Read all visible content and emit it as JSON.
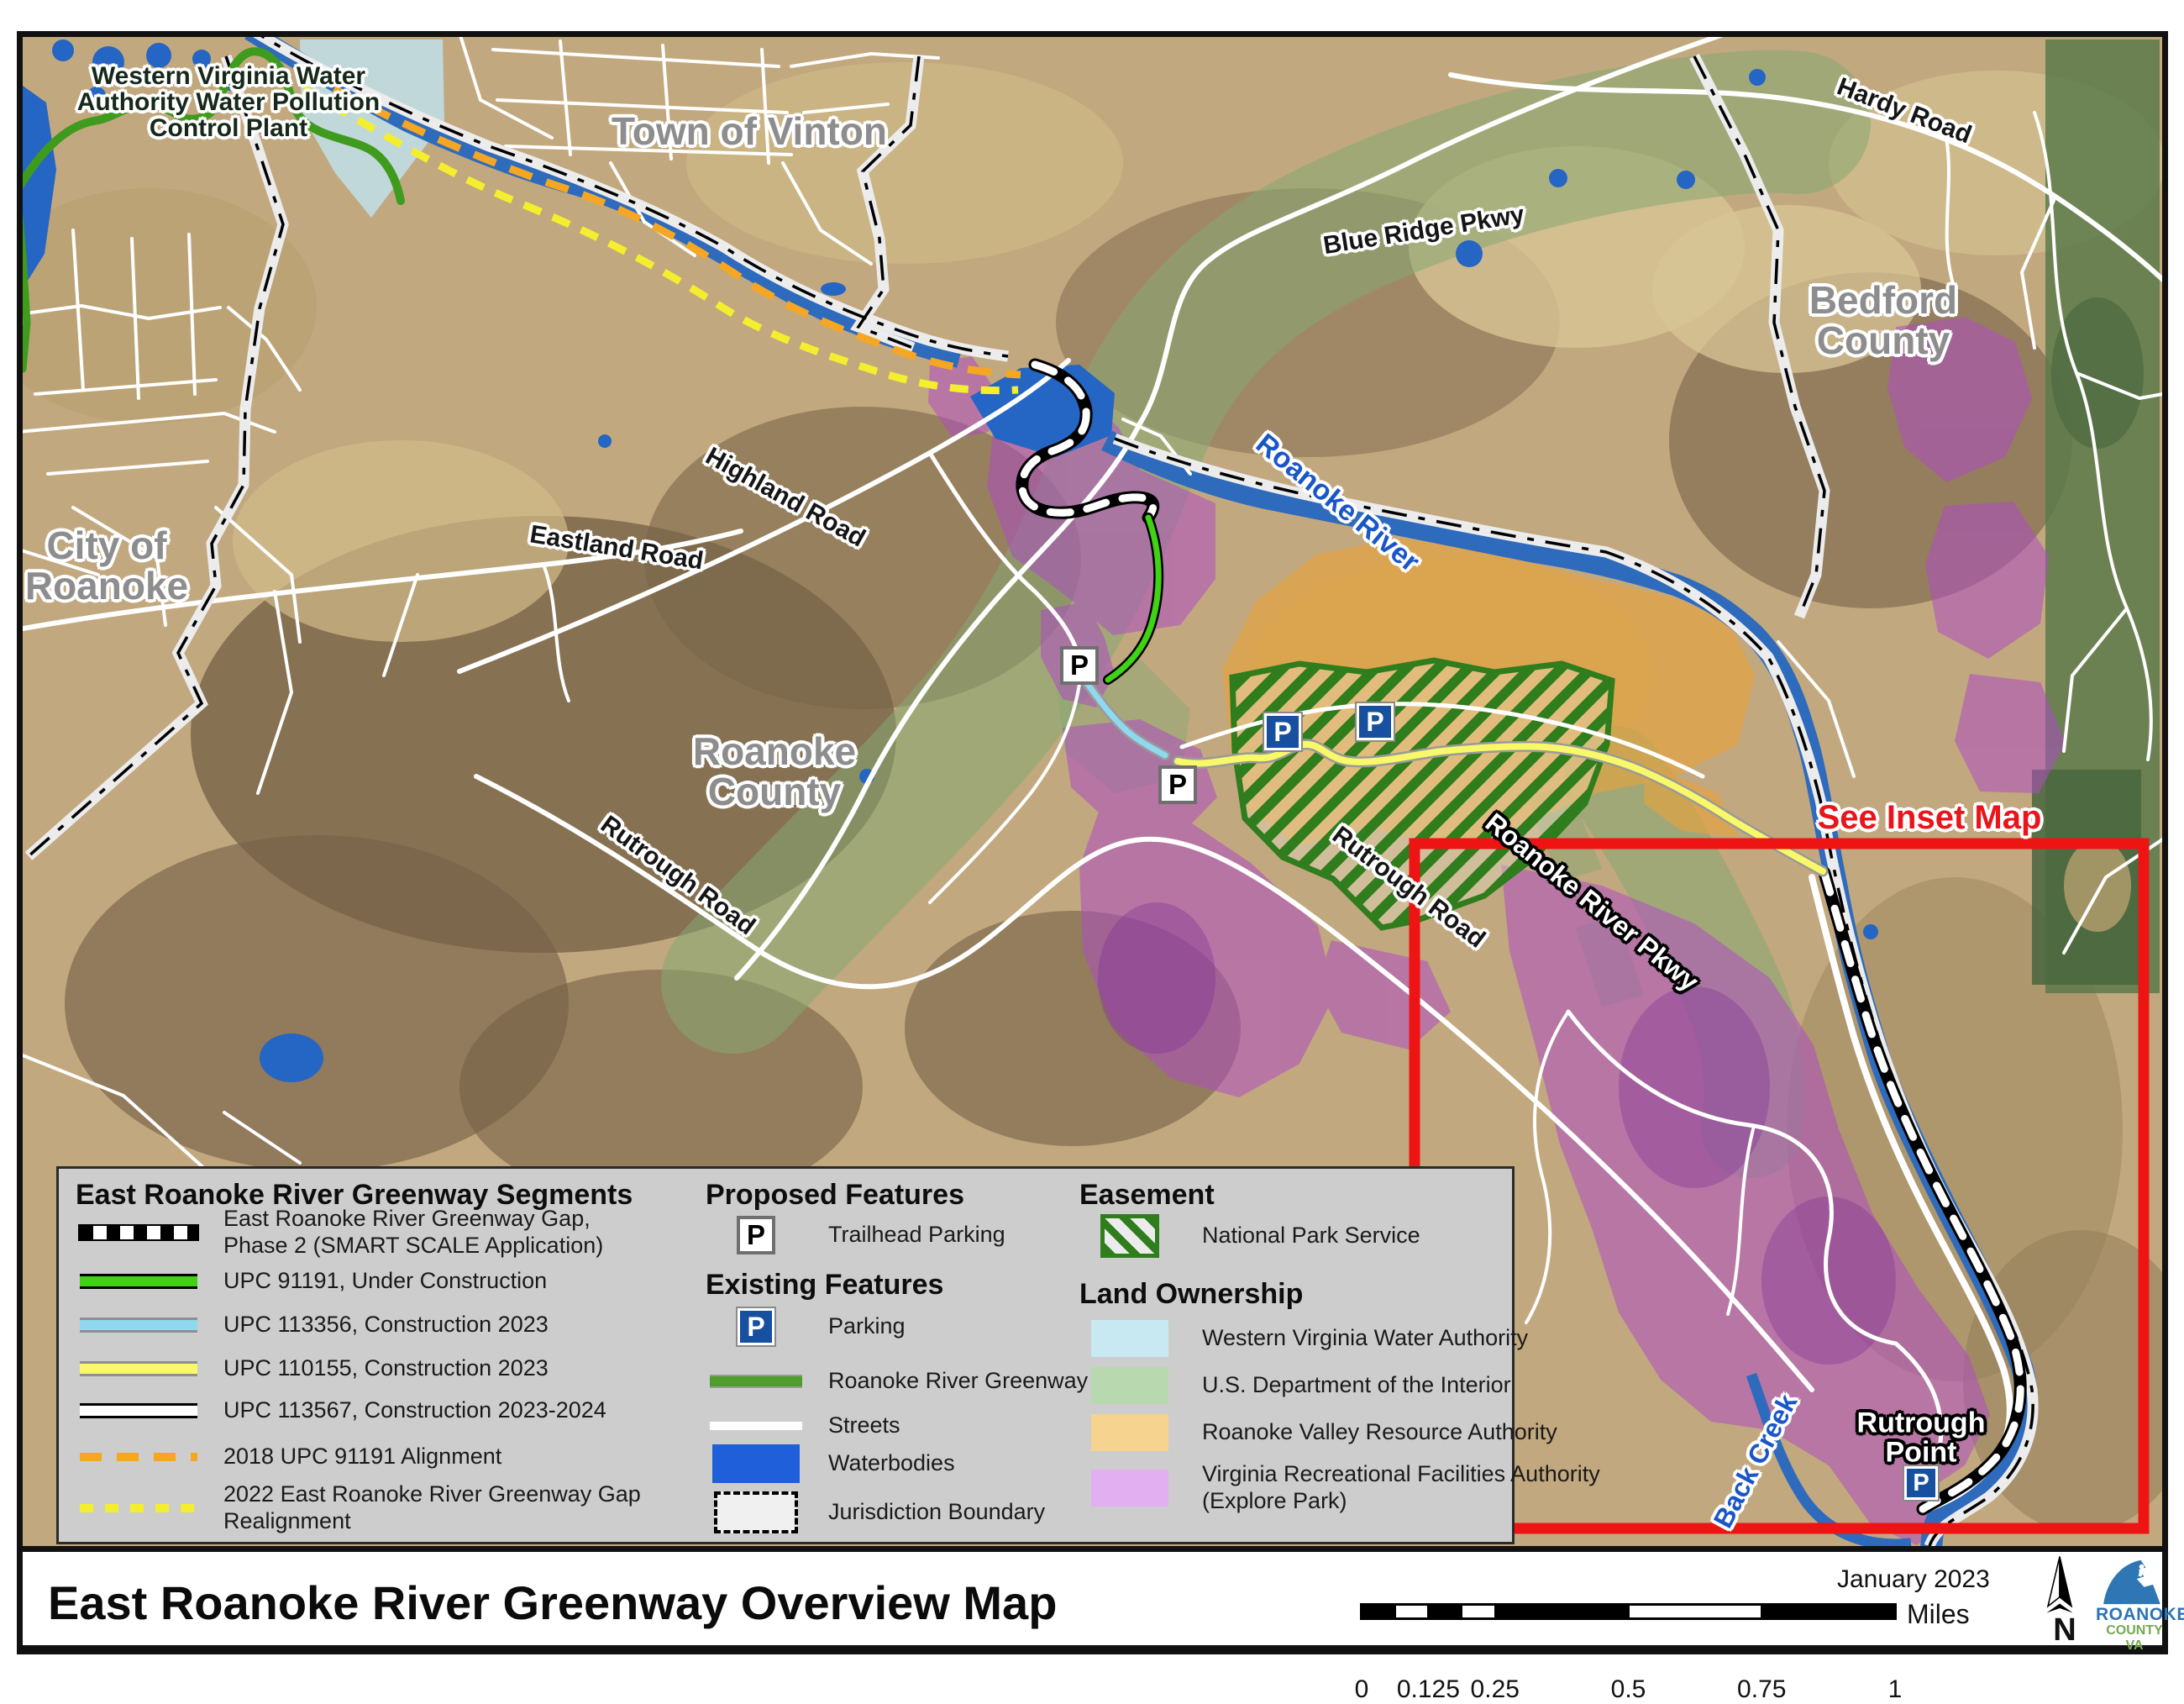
{
  "palette": {
    "inset_red": "#ee1414",
    "parking_blue": "#17509e",
    "upc_green": "#3fd313",
    "upc_cyan": "#8fd8ef",
    "upc_yellow": "#f8f868",
    "dash_orange_2018": "#f5a623",
    "dash_yellow_2022": "#f4ee2e",
    "greenway_green": "#4f9e2d",
    "waterbody_blue": "#1f5fd9",
    "nps_hatch_green": "#2f7d1d",
    "own_wvwa_blue": "#c9e9f2",
    "own_doi_green": "#b8d8b0",
    "own_rvra_orange": "#f6d38e",
    "own_vrfa_purple": "#e2aff0",
    "legend_gray": "#cdcdcd"
  },
  "map": {
    "p_letter": "P",
    "labels": {
      "plant": {
        "l1": "Western Virginia Water",
        "l2": "Authority Water Pollution",
        "l3": "Control Plant"
      },
      "vinton": "Town of Vinton",
      "city": {
        "l1": "City of",
        "l2": "Roanoke"
      },
      "county": {
        "l1": "Roanoke",
        "l2": "County"
      },
      "bedford": {
        "l1": "Bedford",
        "l2": "County"
      },
      "hardy": "Hardy Road",
      "blue_ridge": "Blue Ridge Pkwy",
      "roanoke_river": "Roanoke River",
      "highland": "Highland Road",
      "eastland": "Eastland Road",
      "rutrough_w": "Rutrough Road",
      "rutrough_e": "Rutrough Road",
      "river_pkwy": "Roanoke River Pkwy",
      "see_inset": "See Inset Map",
      "rutrough_point": {
        "l1": "Rutrough",
        "l2": "Point"
      },
      "back_creek": "Back Creek"
    }
  },
  "legend": {
    "segments": {
      "heading": "East Roanoke River Greenway Segments",
      "gap": {
        "l1": "East Roanoke River Greenway Gap,",
        "l2": "Phase 2 (SMART SCALE Application)"
      },
      "upc91191": "UPC 91191, Under Construction",
      "upc113356": "UPC 113356, Construction 2023",
      "upc110155": "UPC 110155, Construction 2023",
      "upc113567": "UPC 113567, Construction 2023-2024",
      "align2018": "2018 UPC 91191 Alignment",
      "realign2022": {
        "l1": "2022 East Roanoke River Greenway Gap",
        "l2": "Realignment"
      }
    },
    "proposed": {
      "heading": "Proposed Features",
      "trailhead": "Trailhead Parking"
    },
    "existing": {
      "heading": "Existing Features",
      "parking": "Parking",
      "greenway": "Roanoke River Greenway",
      "streets": "Streets",
      "waterbodies": "Waterbodies",
      "jurisdiction": "Jurisdiction Boundary"
    },
    "easement": {
      "heading": "Easement",
      "nps": "National Park Service"
    },
    "ownership": {
      "heading": "Land Ownership",
      "wvwa": "Western Virginia Water Authority",
      "doi": "U.S. Department of the Interior",
      "rvra": "Roanoke Valley Resource Authority",
      "vrfa": {
        "l1": "Virginia Recreational Facilities Authority",
        "l2": "(Explore Park)"
      }
    }
  },
  "titlebar": {
    "title": "East Roanoke River Greenway Overview Map",
    "date": "January 2023",
    "miles": "Miles",
    "ticks": [
      "0",
      "0.125",
      "0.25",
      "0.5",
      "0.75",
      "1"
    ],
    "north": "N",
    "logo1": "ROANOKE",
    "logo2": "COUNTY VA"
  }
}
